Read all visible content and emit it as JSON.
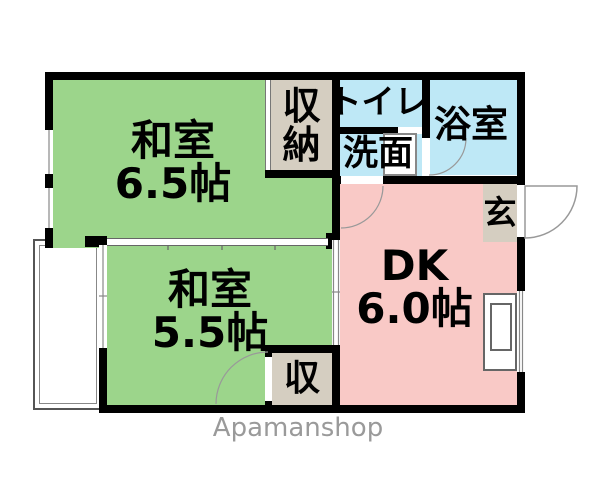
{
  "floorplan": {
    "watermark": "Apamanshop",
    "colors": {
      "tatami_green": "#9cd58b",
      "dk_pink": "#f9c9c6",
      "wet_blue": "#bee8f6",
      "closet_beige": "#d5cec1",
      "wall_black": "#000000",
      "watermark_gray": "#9a9a9a"
    },
    "rooms": {
      "washitsu65": {
        "name": "和室",
        "size": "6.5帖"
      },
      "washitsu55": {
        "name": "和室",
        "size": "5.5帖"
      },
      "dk": {
        "name": "DK",
        "size": "6.0帖"
      },
      "closet_top": {
        "char1": "収",
        "char2": "納"
      },
      "toilet": {
        "name": "トイレ"
      },
      "washroom": {
        "name": "洗面"
      },
      "bathroom": {
        "name": "浴室"
      },
      "entrance": {
        "name": "玄"
      },
      "closet_bottom": {
        "name": "収"
      }
    }
  }
}
